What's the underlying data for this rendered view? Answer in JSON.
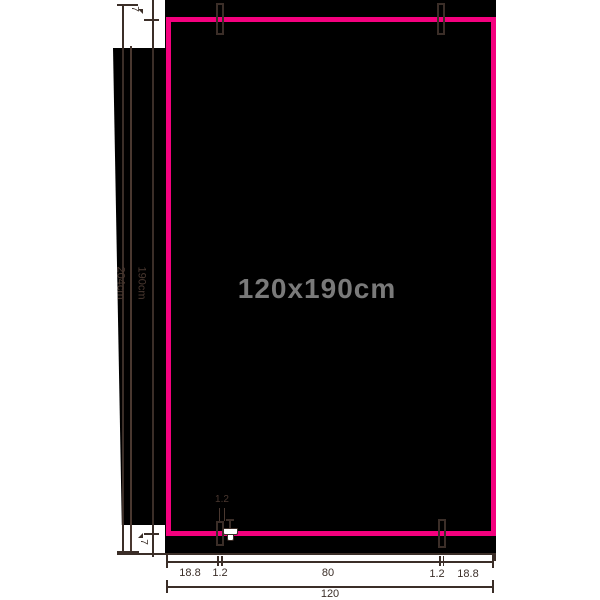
{
  "diagram": {
    "title_label": "120x190cm",
    "left_dims": {
      "total_height": "204cm",
      "visible_height": "190cm",
      "top_gap": "7",
      "bottom_gap": "7"
    },
    "bottom_dims": {
      "row1": [
        "18.8",
        "1.2",
        "80",
        "1.2",
        "18.8"
      ],
      "total_width": "120",
      "rail_width": "1.2"
    },
    "colors": {
      "outline_pink": "#F4007E",
      "line_dark": "#3B2E28",
      "title_gray": "#7A7A7A",
      "fill_black": "#000000",
      "background_white": "#FFFFFF",
      "clamp_white": "#FFFFFF"
    },
    "icons": {
      "clamp": "clamp-icon",
      "top_rail_ticks": "rail-tick-rect",
      "dimension_darts": "dimension-arrow"
    }
  }
}
